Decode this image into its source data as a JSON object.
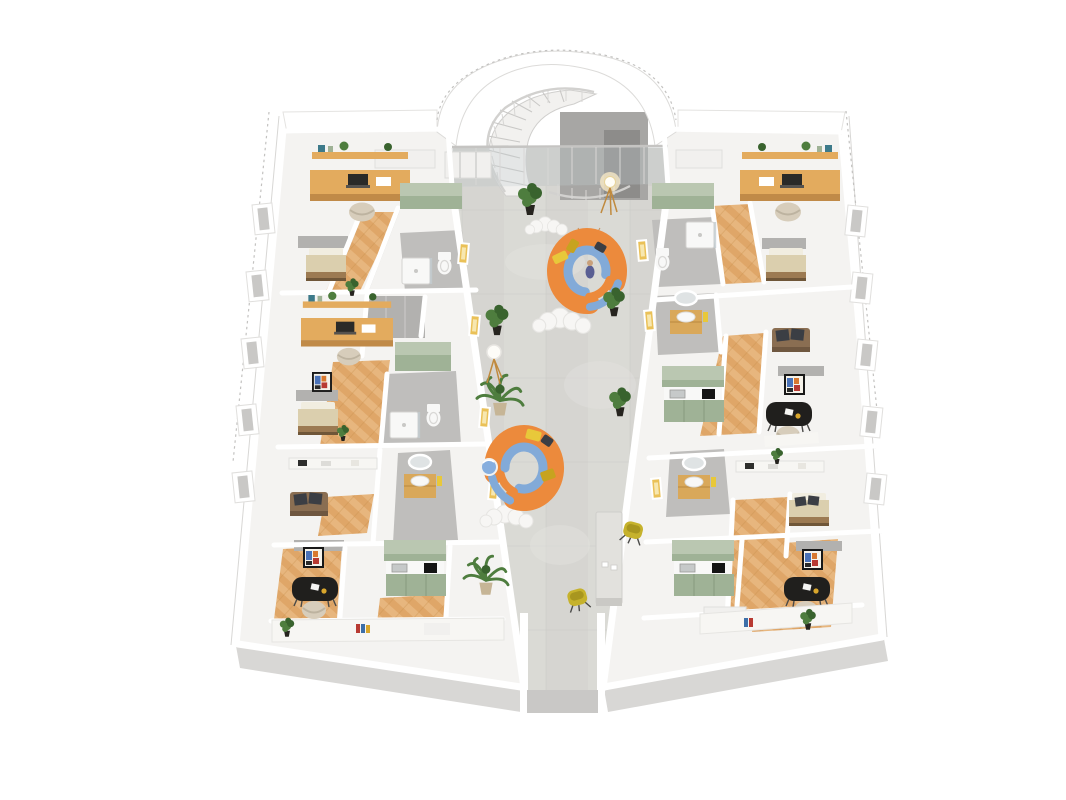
{
  "meta": {
    "label": "3D dollhouse floor plan rendering of an apartment floor with central atrium corridor, spiral staircase, curved orange lounge sofas and eight furnished unit areas"
  },
  "palette": {
    "wall_white": "#ffffff",
    "cabinet_white": "#f1f0ee",
    "bench_white": "#f7f6f3",
    "slab": "#f4f3f1",
    "wall_shade": "#d8d7d5",
    "wall_mid": "#c9c8c6",
    "wall_gray": "#b2b1af",
    "partition_dark": "#a7a6a4",
    "door_dark": "#8d8c8a",
    "dash": "#c3c2c0",
    "rail": "#d2d1cf",
    "concrete": "#d6d5d1",
    "concrete_light": "#e2e1dd",
    "concrete_dark": "#c6c5c1",
    "corridor_top": "#d1d0cc",
    "wood": "#dfa668",
    "wood_light": "#edc28c",
    "wood_dark": "#c08a48",
    "sage": "#9fb296",
    "sage_top": "#bac7b1",
    "sage_dark": "#87997e",
    "desk_wood": "#e3ab5e",
    "sofa_orange": "#ec8a3c",
    "sofa_orange_dark": "#d06f28",
    "cushion_blue": "#82aad8",
    "pillow_yellow": "#e8c83a",
    "pillow_mustard": "#c7a31f",
    "pillow_dark": "#3b3e44",
    "chair_yellow": "#c6b22c",
    "chair_yellow_dark": "#a8961f",
    "chair_beige": "#d7cdbb",
    "bed_beige": "#dbcfae",
    "bed_frame": "#9c7a52",
    "bed_pillow": "#f1ede0",
    "sofa_brown": "#8a6e52",
    "sofa_brown_dark": "#6f5740",
    "fixture": "#f8f8f7",
    "bath_floor": "#bfbebc",
    "glass": "#c3ccd0",
    "plant": "#4e7d3e",
    "plant_dark": "#39632e",
    "pot_black": "#26241f",
    "pot_beige": "#c6b596",
    "black": "#201f1d",
    "art_frame": "#181818",
    "glow": "#eac158",
    "glow_light": "#f7e7b0",
    "vanity": "#d9a85a",
    "table_gray": "#e2e1dd",
    "rug": "#f7f6f4",
    "rug_edge": "#e6e5e2",
    "lamp_leg": "#c08a3e"
  }
}
